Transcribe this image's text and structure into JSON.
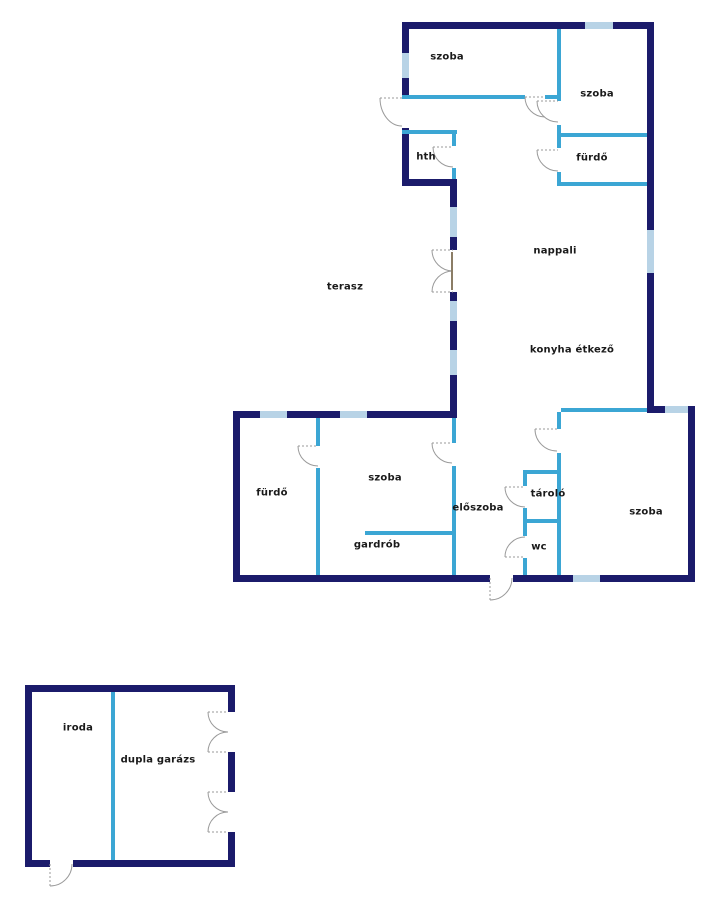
{
  "palette": {
    "outer_wall": "#1b1b6b",
    "inner_wall": "#3ba6d4",
    "window": "#b8d3e6",
    "door_arc": "#9a9a9a",
    "door_leaf": "#8b7d66",
    "label_text": "#1a1a1a",
    "background": "#ffffff"
  },
  "rooms": {
    "szoba_top_left": {
      "label": "szoba"
    },
    "szoba_top_right": {
      "label": "szoba"
    },
    "furdo_top": {
      "label": "fürdő"
    },
    "hth": {
      "label": "hth"
    },
    "nappali": {
      "label": "nappali"
    },
    "terasz": {
      "label": "terasz"
    },
    "konyha_etkezo": {
      "label": "konyha étkező"
    },
    "furdo_lower": {
      "label": "fürdő"
    },
    "szoba_middle": {
      "label": "szoba"
    },
    "gardrob": {
      "label": "gardrób"
    },
    "eloszoba": {
      "label": "előszoba"
    },
    "tarolo": {
      "label": "tároló"
    },
    "wc": {
      "label": "wc"
    },
    "szoba_bottom_right": {
      "label": "szoba"
    },
    "iroda": {
      "label": "iroda"
    },
    "dupla_garazs": {
      "label": "dupla garázs"
    }
  }
}
